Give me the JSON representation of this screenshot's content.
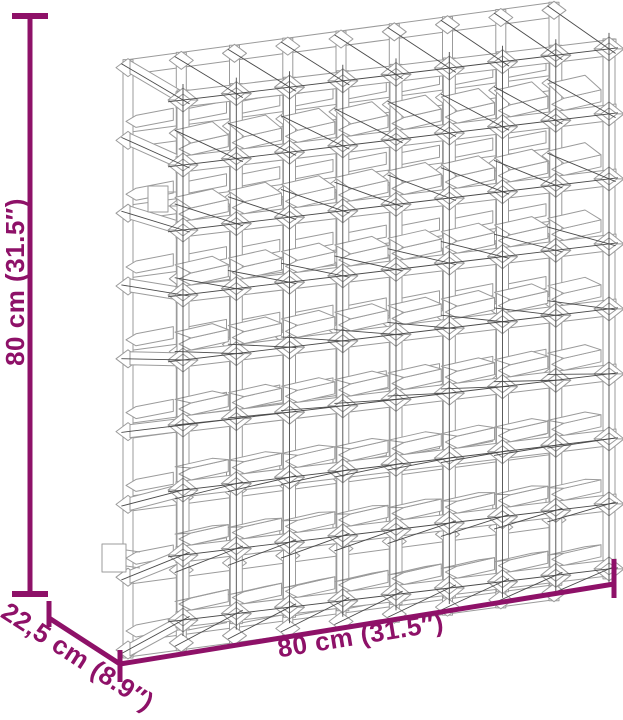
{
  "page": {
    "background": "#ffffff"
  },
  "figure": {
    "kind": "product-dimension-diagram",
    "subject": "wine-rack-wireframe",
    "grid": {
      "rows": 8,
      "cols": 8
    },
    "colors": {
      "dimension_accent": "#8E1168",
      "wire_light": "#9b9b9b",
      "wire_dark": "#4a4a4a",
      "fill": "#ffffff",
      "background": "#ffffff"
    }
  },
  "dimensions": {
    "height": {
      "label": "80 cm (31.5″)"
    },
    "width": {
      "label": "80 cm (31.5″)"
    },
    "depth": {
      "label": "22,5 cm (8.9″)"
    }
  }
}
